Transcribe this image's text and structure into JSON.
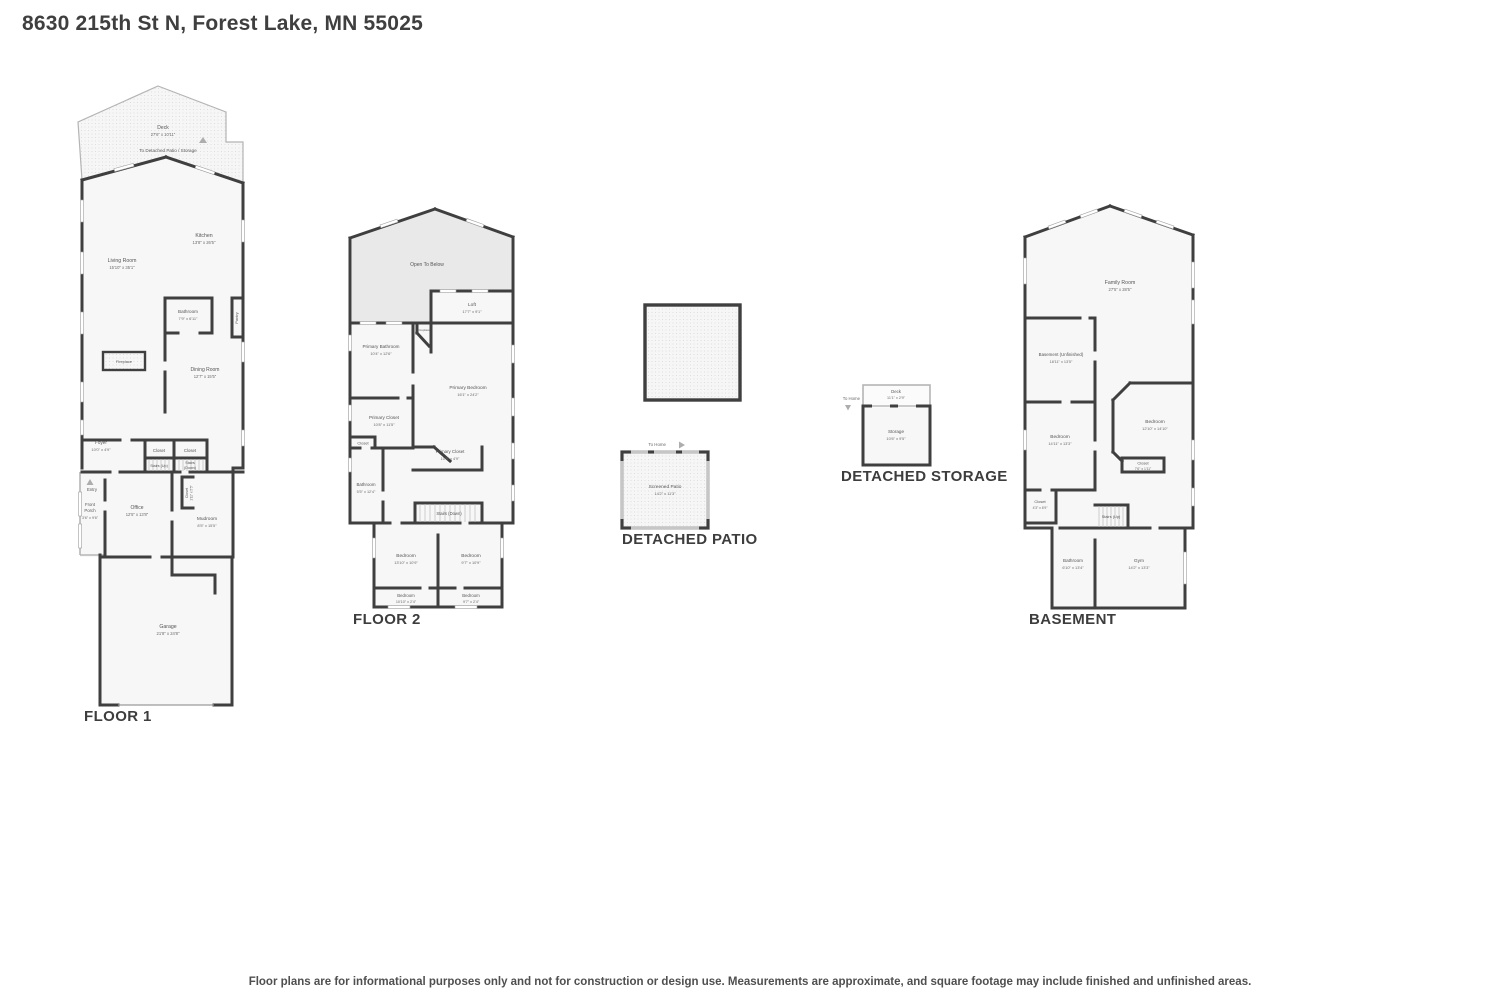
{
  "page": {
    "title": "8630 215th St N, Forest Lake, MN 55025",
    "disclaimer": "Floor plans are for informational purposes only and not for construction or design use. Measurements are approximate, and square footage may include finished and unfinished areas."
  },
  "floor1": {
    "heading": "FLOOR 1",
    "deck_name": "Deck",
    "deck_dims": "27'6\" x 10'11\"",
    "to_detached": "To Detached Patio / Storage",
    "living_name": "Living Room",
    "living_dims": "15'10\" x 35'1\"",
    "kitchen_name": "Kitchen",
    "kitchen_dims": "13'8\" x 26'5\"",
    "bathroom_name": "Bathroom",
    "bathroom_dims": "7'9\" x 6'11\"",
    "pantry": "Pantry",
    "fireplace": "Fireplace",
    "dining_name": "Dining Room",
    "dining_dims": "12'7\" x 15'5\"",
    "foyer_name": "Foyer",
    "foyer_dims": "10'0\" x 4'9\"",
    "closet_a": "Closet",
    "closet_b": "Closet",
    "stairs_up": "Stairs (Up)",
    "stairs_down_1": "Stairs",
    "stairs_down_2": "(Down)",
    "entry": "Entry",
    "porch_1": "Front",
    "porch_2": "Porch",
    "porch_dims": "3'6\" x 9'6\"",
    "office_name": "Office",
    "office_dims": "12'5\" x 13'8\"",
    "closet_c_name": "Closet",
    "closet_c_dims": "1'11\" x 5'5\"",
    "mudroom_name": "Mudroom",
    "mudroom_dims": "8'5\" x 15'5\"",
    "garage_name": "Garage",
    "garage_dims": "21'8\" x 24'8\""
  },
  "floor2": {
    "heading": "FLOOR 2",
    "open_to_below": "Open To Below",
    "loft_name": "Loft",
    "loft_dims": "17'7\" x 9'1\"",
    "fireplace": "Fireplace",
    "pbath_name": "Primary Bathroom",
    "pbath_dims": "10'4\" x 12'6\"",
    "pbed_name": "Primary Bedroom",
    "pbed_dims": "16'1\" x 24'2\"",
    "pcloset1_name": "Primary Closet",
    "pcloset1_dims": "10'8\" x 11'5\"",
    "closet_small": "Closet",
    "pcloset2_name": "Primary Closet",
    "pcloset2_dims": "10'8\" x 4'9\"",
    "bath_name": "Bathroom",
    "bath_dims": "5'5\" x 12'4\"",
    "stairs_down": "Stairs (Down)",
    "bed1_name": "Bedroom",
    "bed1_dims": "13'10\" x 10'9\"",
    "bed2_name": "Bedroom",
    "bed2_dims": "9'7\" x 10'9\"",
    "bed3_name": "Bedroom",
    "bed3_dims": "10'10\" x 2'4\"",
    "bed4_name": "Bedroom",
    "bed4_dims": "9'7\" x 2'4\""
  },
  "patio": {
    "heading": "DETACHED PATIO",
    "to_home": "To Home",
    "screened_name": "Screened Patio",
    "screened_dims": "14'2\" x 11'3\""
  },
  "storage": {
    "heading": "DETACHED STORAGE",
    "to_home": "To Home",
    "deck_name": "Deck",
    "deck_dims": "11'1\" x 2'9\"",
    "storage_name": "Storage",
    "storage_dims": "10'6\" x 9'5\""
  },
  "basement": {
    "heading": "BASEMENT",
    "family_name": "Family Room",
    "family_dims": "27'5\" x 28'5\"",
    "unf_name": "Basement (Unfinished)",
    "unf_dims": "18'11\" x 13'5\"",
    "bed1_name": "Bedroom",
    "bed1_dims": "14'11\" x 13'3\"",
    "bed2_name": "Bedroom",
    "bed2_dims": "12'10\" x 14'10\"",
    "closet1_name": "Closet",
    "closet1_dims": "7'6\" x 1'11\"",
    "closet2_name": "Closet",
    "closet2_dims": "4'3\" x 6'9\"",
    "stairs_up": "Stairs (Up)",
    "bath_name": "Bathroom",
    "bath_dims": "6'10\" x 13'4\"",
    "gym_name": "Gym",
    "gym_dims": "14'2\" x 13'3\""
  }
}
